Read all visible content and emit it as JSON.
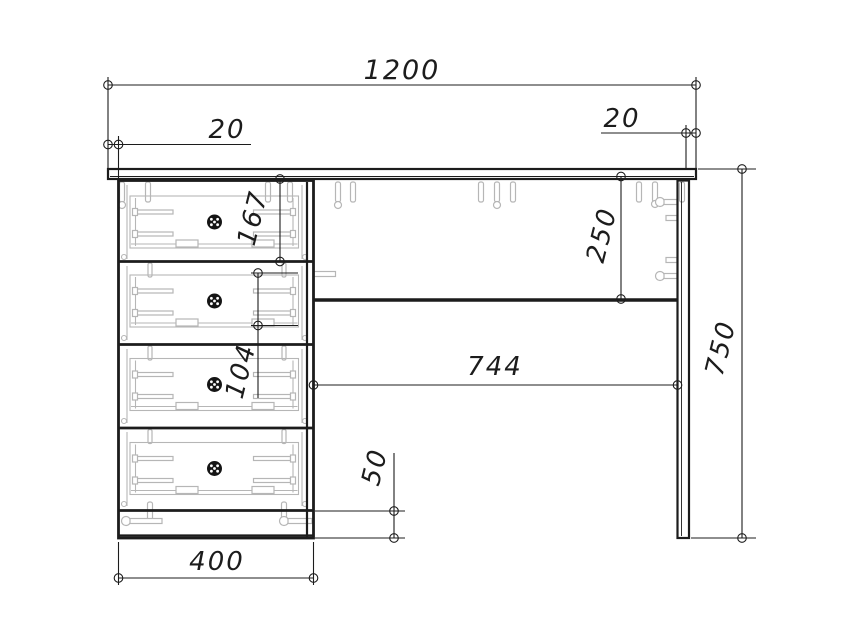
{
  "dimensions": {
    "overall_width": "1200",
    "overhang_left": "20",
    "overhang_right": "20",
    "drawer_front_height": "167",
    "drawer_side_height": "104",
    "back_panel_height": "250",
    "knee_space_width": "744",
    "plinth_height": "50",
    "pedestal_width": "400",
    "overall_height": "750"
  },
  "colors": {
    "line": "#1c1c1c",
    "hardware": "#b6b6b6",
    "background": "#ffffff"
  }
}
